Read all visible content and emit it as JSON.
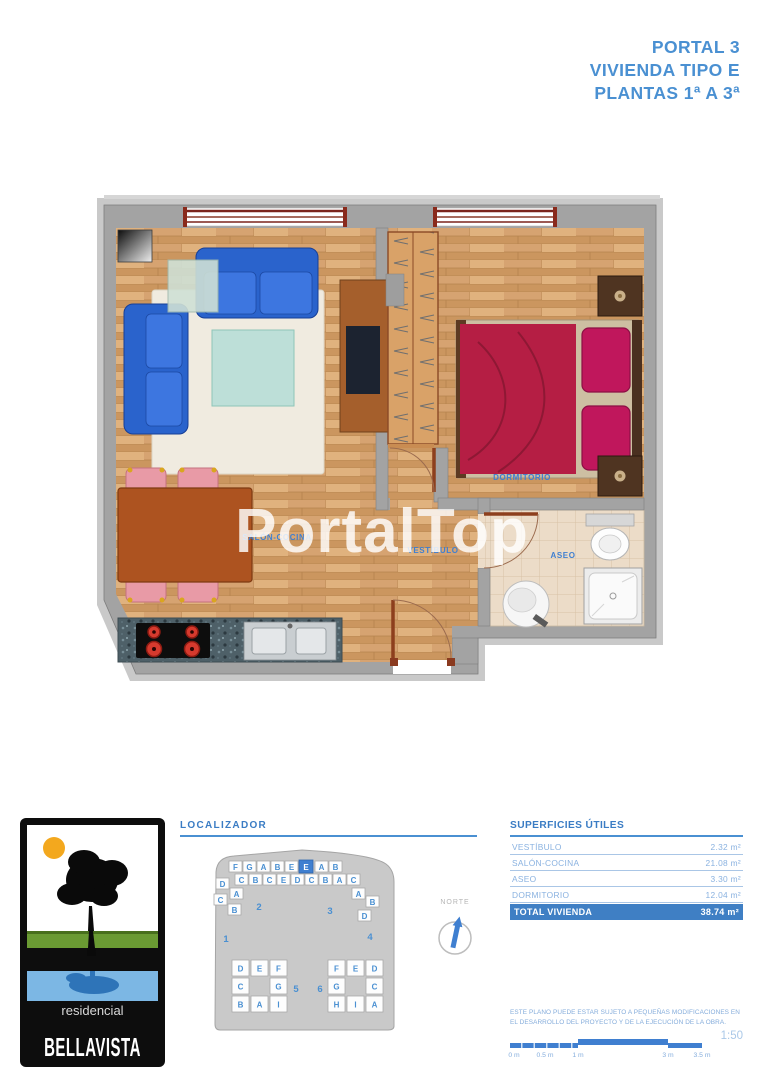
{
  "header": {
    "lines": [
      "PORTAL 3",
      "VIVIENDA TIPO E",
      "PLANTAS 1ª A 3ª"
    ]
  },
  "watermark": "PortalTop",
  "plan": {
    "room_labels": {
      "salon": "SALÓN-COCINA",
      "vestibulo": "VESTÍBULO",
      "aseo": "ASEO",
      "dormitorio": "DORMITORIO"
    }
  },
  "logo": {
    "line1": "residencial",
    "line2": "BELLAVISTA"
  },
  "localizador": {
    "title": "LOCALIZADOR",
    "compass_label": "NORTE",
    "highlighted_unit": "E",
    "strip_row1": [
      "F",
      "G",
      "A",
      "B",
      "E",
      "A",
      "B"
    ],
    "strip_row2": [
      "C",
      "B",
      "C",
      "E",
      "D",
      "C",
      "B",
      "A",
      "C"
    ],
    "left_wing": [
      "D",
      "A",
      "C",
      "B"
    ],
    "right_wing": [
      "A",
      "B",
      "D"
    ],
    "cluster5": [
      "D",
      "E",
      "F",
      "C",
      "G",
      "B",
      "A",
      "I"
    ],
    "cluster6": [
      "F",
      "E",
      "D",
      "G",
      "C",
      "H",
      "I",
      "A"
    ],
    "block_numbers": [
      "1",
      "2",
      "3",
      "4",
      "5",
      "6"
    ]
  },
  "superficies": {
    "title": "SUPERFICIES ÚTILES",
    "rows": [
      {
        "label": "VESTÍBULO",
        "value": "2.32 m²"
      },
      {
        "label": "SALÓN-COCINA",
        "value": "21.08 m²"
      },
      {
        "label": "ASEO",
        "value": "3.30 m²"
      },
      {
        "label": "DORMITORIO",
        "value": "12.04 m²"
      }
    ],
    "total": {
      "label": "TOTAL VIVIENDA",
      "value": "38.74 m²"
    }
  },
  "disclaimer": [
    "ESTE PLANO PUEDE ESTAR SUJETO A PEQUEÑAS MODIFICACIONES EN",
    "EL DESARROLLO DEL PROYECTO Y DE LA EJECUCIÓN DE LA OBRA."
  ],
  "scale": {
    "ratio": "1:50",
    "ticks": [
      "0 m",
      "0.5 m",
      "1 m",
      "3 m",
      "3.5 m"
    ]
  },
  "colors": {
    "accent_blue": "#4a90d2",
    "table_total_bg": "#3f7fc4"
  }
}
